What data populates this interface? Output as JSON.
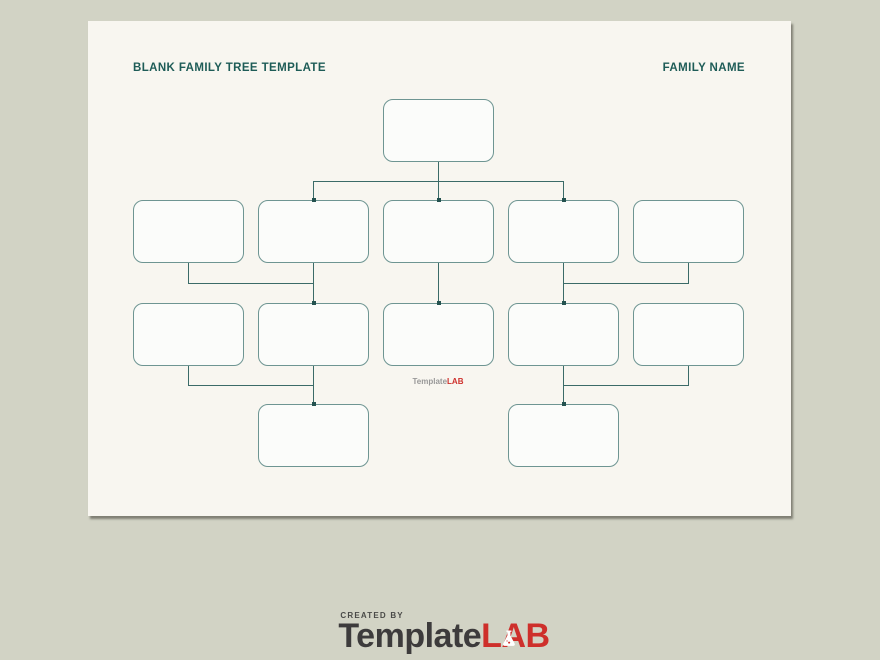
{
  "header": {
    "title": "BLANK FAMILY TREE TEMPLATE",
    "family_name_label": "FAMILY NAME"
  },
  "tree": {
    "type": "family-tree",
    "box_count": 13,
    "rows": [
      {
        "generation": 1,
        "boxes": 1
      },
      {
        "generation": 2,
        "boxes": 5
      },
      {
        "generation": 3,
        "boxes": 5
      },
      {
        "generation": 4,
        "boxes": 2
      }
    ],
    "boxes_are_blank": true
  },
  "watermark": {
    "brand_gray": "Template",
    "brand_red": "LAB"
  },
  "footer": {
    "created_by": "CREATED BY",
    "brand_gray": "Template",
    "brand_red": "LAB"
  },
  "colors": {
    "canvas_bg": "#d2d3c5",
    "page_bg": "#f8f6f0",
    "box_fill": "#fbfcfa",
    "box_border": "#6e9592",
    "connector": "#3b6b68",
    "connector_dark": "#24524f",
    "title_teal": "#1e5c57",
    "brand_red": "#ce2f2b",
    "brand_gray": "#3d3b3c",
    "watermark_gray": "#989898"
  }
}
